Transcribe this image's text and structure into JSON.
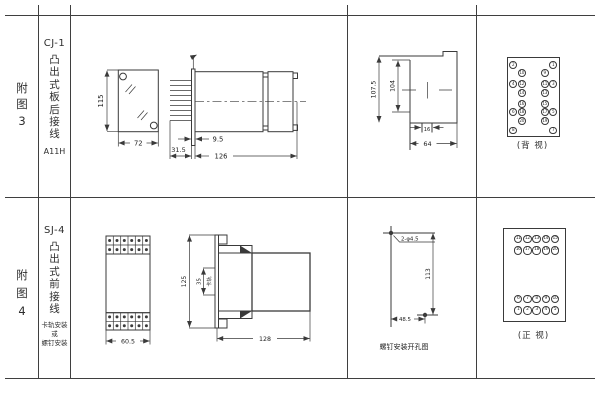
{
  "figures": [
    {
      "label_chars": [
        "附",
        "图",
        "3"
      ],
      "model": "CJ-1",
      "mount_chars": [
        "凸",
        "出",
        "式",
        "板",
        "后",
        "接",
        "线"
      ],
      "code": "A11H",
      "front": {
        "height": "115",
        "width": "72"
      },
      "side": {
        "pin_len": "31.5",
        "offset": "9.5",
        "length": "126"
      },
      "cutout": {
        "outer_h": "107.5",
        "inner_h": "104",
        "notch_w": "16",
        "width": "64"
      },
      "terminal_view": {
        "caption": "(背 视)",
        "rows": [
          [
            "2",
            "",
            "",
            "1"
          ],
          [
            "",
            "10",
            "9",
            ""
          ],
          [
            "4",
            "12",
            "11",
            "3"
          ],
          [
            "",
            "14",
            "13",
            ""
          ],
          [
            "",
            "16",
            "15",
            ""
          ],
          [
            "6",
            "18",
            "17",
            "5"
          ],
          [
            "",
            "20",
            "19",
            ""
          ],
          [
            "8",
            "",
            "",
            "7"
          ]
        ]
      }
    },
    {
      "label_chars": [
        "附",
        "图",
        "4"
      ],
      "model": "SJ-4",
      "mount_chars": [
        "凸",
        "出",
        "式",
        "前",
        "接",
        "线"
      ],
      "mount_notes": [
        "卡轨安装",
        "或",
        "螺钉安装"
      ],
      "front": {
        "width": "60.5"
      },
      "side": {
        "height": "125",
        "rail": "35",
        "rail_label": "卡轨",
        "length": "128"
      },
      "drill": {
        "holes": "2-φ4.5",
        "v": "113",
        "h": "48.5",
        "caption": "螺钉安装开孔图"
      },
      "terminal_view": {
        "caption": "(正 视)",
        "top_rows": [
          [
            "11",
            "12",
            "13",
            "14",
            "15"
          ],
          [
            "16",
            "17",
            "18",
            "19",
            "20"
          ]
        ],
        "bottom_rows": [
          [
            "6",
            "7",
            "8",
            "9",
            "10"
          ],
          [
            "1",
            "2",
            "3",
            "4",
            "5"
          ]
        ]
      }
    }
  ]
}
